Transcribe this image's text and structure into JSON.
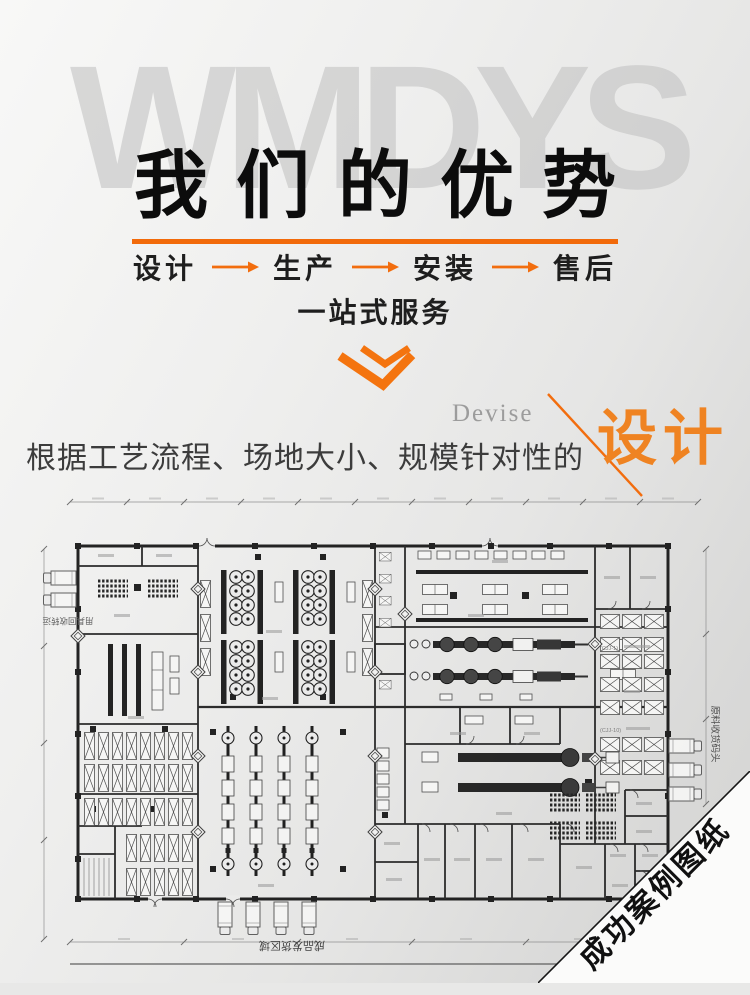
{
  "watermark": "WMDYS",
  "header": {
    "title": "我们的优势"
  },
  "process": {
    "steps": [
      "设计",
      "生产",
      "安装",
      "售后"
    ],
    "tagline": "一站式服务"
  },
  "design_section": {
    "eyebrow": "Devise",
    "keyword": "设计",
    "description": "根据工艺流程、场地大小、规模针对性的"
  },
  "floor_plan": {
    "labels": {
      "left_dock": "用具回收转运",
      "right_dock": "原料收货码头",
      "bottom_dock": "成品发货区域",
      "rack_row_1": "(CJJ-1)",
      "rack_row_2": "(CJJ-10)"
    }
  },
  "corner_banner": {
    "label": "成功案例图纸"
  },
  "icons": {
    "flow_arrow": "long-right-arrow",
    "section_marker": "double-chevron-down",
    "divider": "diagonal-slash-line"
  },
  "colors": {
    "accent": "#f26d0e",
    "keyword_orange": "#ef8322",
    "ink": "#1b1b1b"
  }
}
